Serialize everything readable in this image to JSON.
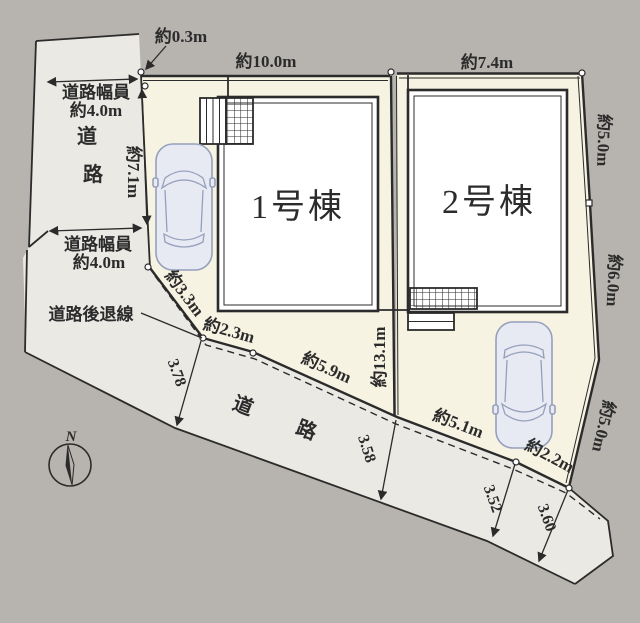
{
  "plan": {
    "buildings": [
      {
        "label": "1号棟"
      },
      {
        "label": "2号棟"
      }
    ],
    "roads": {
      "top_vertical": {
        "char1": "道",
        "char2": "路"
      },
      "bottom_label": "道　路",
      "setback_label": "道路後退線",
      "width_top": {
        "line1": "道路幅員",
        "line2": "約4.0m"
      },
      "width_bottom": {
        "line1": "道路幅員",
        "line2": "約4.0m"
      }
    },
    "dimensions": {
      "offset_top": "約0.3m",
      "top_parcel1": "約10.0m",
      "top_parcel2": "約7.4m",
      "right_upper": "約5.0m",
      "right_middle": "約6.0m",
      "right_lower": "約5.0m",
      "left_parcel1": "約7.1m",
      "center_boundary": "約13.1m",
      "setback_a": "約3.3m",
      "setback_b": "約2.3m",
      "setback_c": "約5.9m",
      "setback_d": "約5.1m",
      "setback_e": "約2.2m",
      "road_w1": "3.78",
      "road_w2": "3.58",
      "road_w3": "3.52",
      "road_w4": "3.60"
    },
    "compass": {
      "north": "N"
    }
  },
  "colors": {
    "background": "#b7b4af",
    "road": "#ebe9e4",
    "parcel": "#f6f3e2",
    "building": "#ffffff",
    "line": "#2b2b2b",
    "car": "#e7eaf3",
    "carline": "#96a0bc"
  }
}
